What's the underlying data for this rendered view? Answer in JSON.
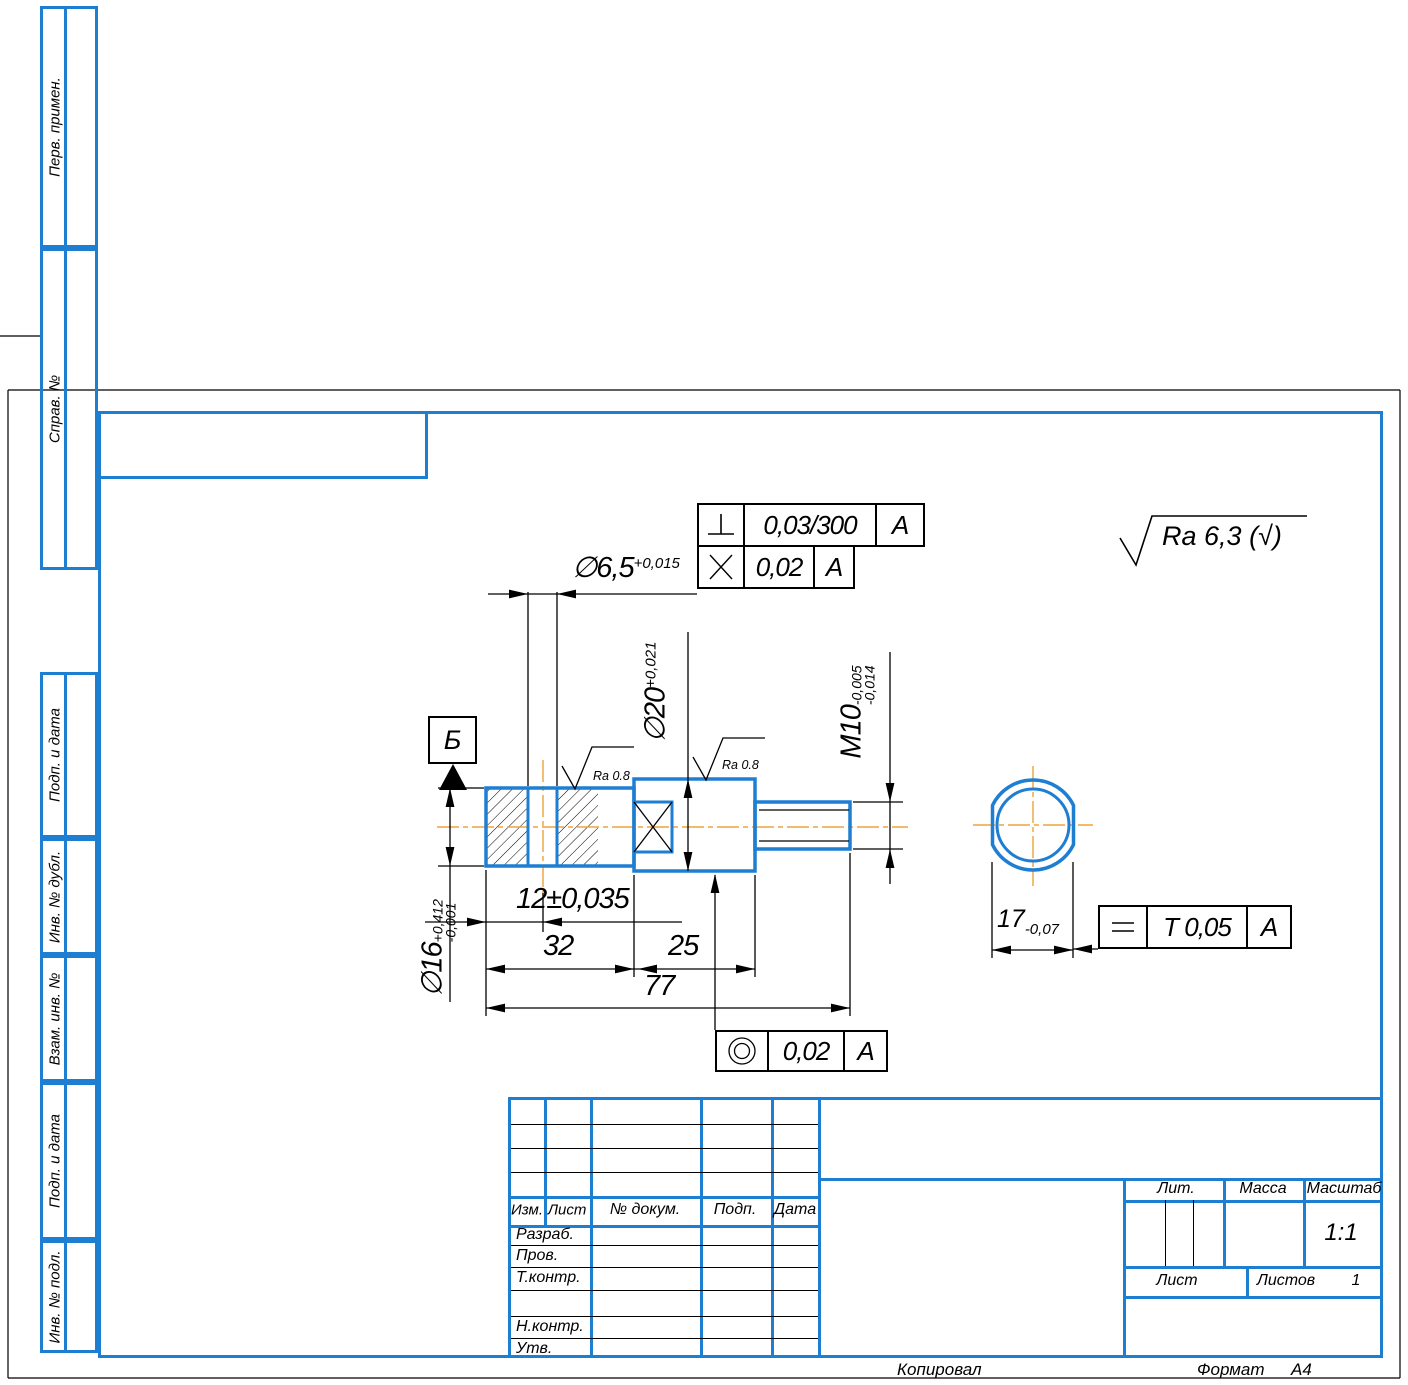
{
  "colors": {
    "line_blue": "#1e7fd2",
    "centerline_orange": "#eda338",
    "line_black": "#000000"
  },
  "margin_labels": [
    {
      "text": "Перв. примен."
    },
    {
      "text": "Справ. №"
    },
    {
      "text": "Подп. и дата"
    },
    {
      "text": "Инв. № дубл."
    },
    {
      "text": "Взам. инв. №"
    },
    {
      "text": "Подп. и дата"
    },
    {
      "text": "Инв. № подл."
    }
  ],
  "dims": {
    "dia65": {
      "base": "∅6,5",
      "upper": "+0,015"
    },
    "dia20": {
      "base": "∅20",
      "upper": "+0,021"
    },
    "m10": {
      "base": "M10",
      "upper": "-0,005",
      "lower": "-0,014"
    },
    "dia16": {
      "base": "∅16",
      "upper": "+0,412",
      "lower": "-0,001"
    },
    "len12": "12±0,035",
    "len32": "32",
    "len25": "25",
    "len77": "77",
    "d17": {
      "base": "17",
      "lower": "-0,07"
    }
  },
  "tolerances": {
    "perp": {
      "symbol": "perpendicularity",
      "value": "0,03/300",
      "datum": "А"
    },
    "cross": {
      "symbol": "axes-crossing",
      "value": "0,02",
      "datum": "А"
    },
    "conc": {
      "symbol": "concentricity",
      "value": "0,02",
      "datum": "А"
    },
    "parallel": {
      "symbol": "parallelism",
      "value": "Т 0,05",
      "datum": "А"
    }
  },
  "datum": {
    "label": "Б"
  },
  "roughness": {
    "general": "Ra 6,3",
    "general_paren": "(√)",
    "local": "Ra 0.8"
  },
  "title_block": {
    "header_cols": [
      "Изм.",
      "Лист",
      "№ докум.",
      "Подп.",
      "Дата"
    ],
    "staff_rows": [
      "Разраб.",
      "Пров.",
      "Т.контр.",
      "",
      "Н.контр.",
      "Утв."
    ],
    "lit": "Лит.",
    "massa": "Масса",
    "masshtab": "Масштаб",
    "scale_value": "1:1",
    "list": "Лист",
    "listov": "Листов",
    "listov_value": "1"
  },
  "footer": {
    "copied": "Копировал",
    "format": "Формат",
    "format_value": "А4"
  }
}
